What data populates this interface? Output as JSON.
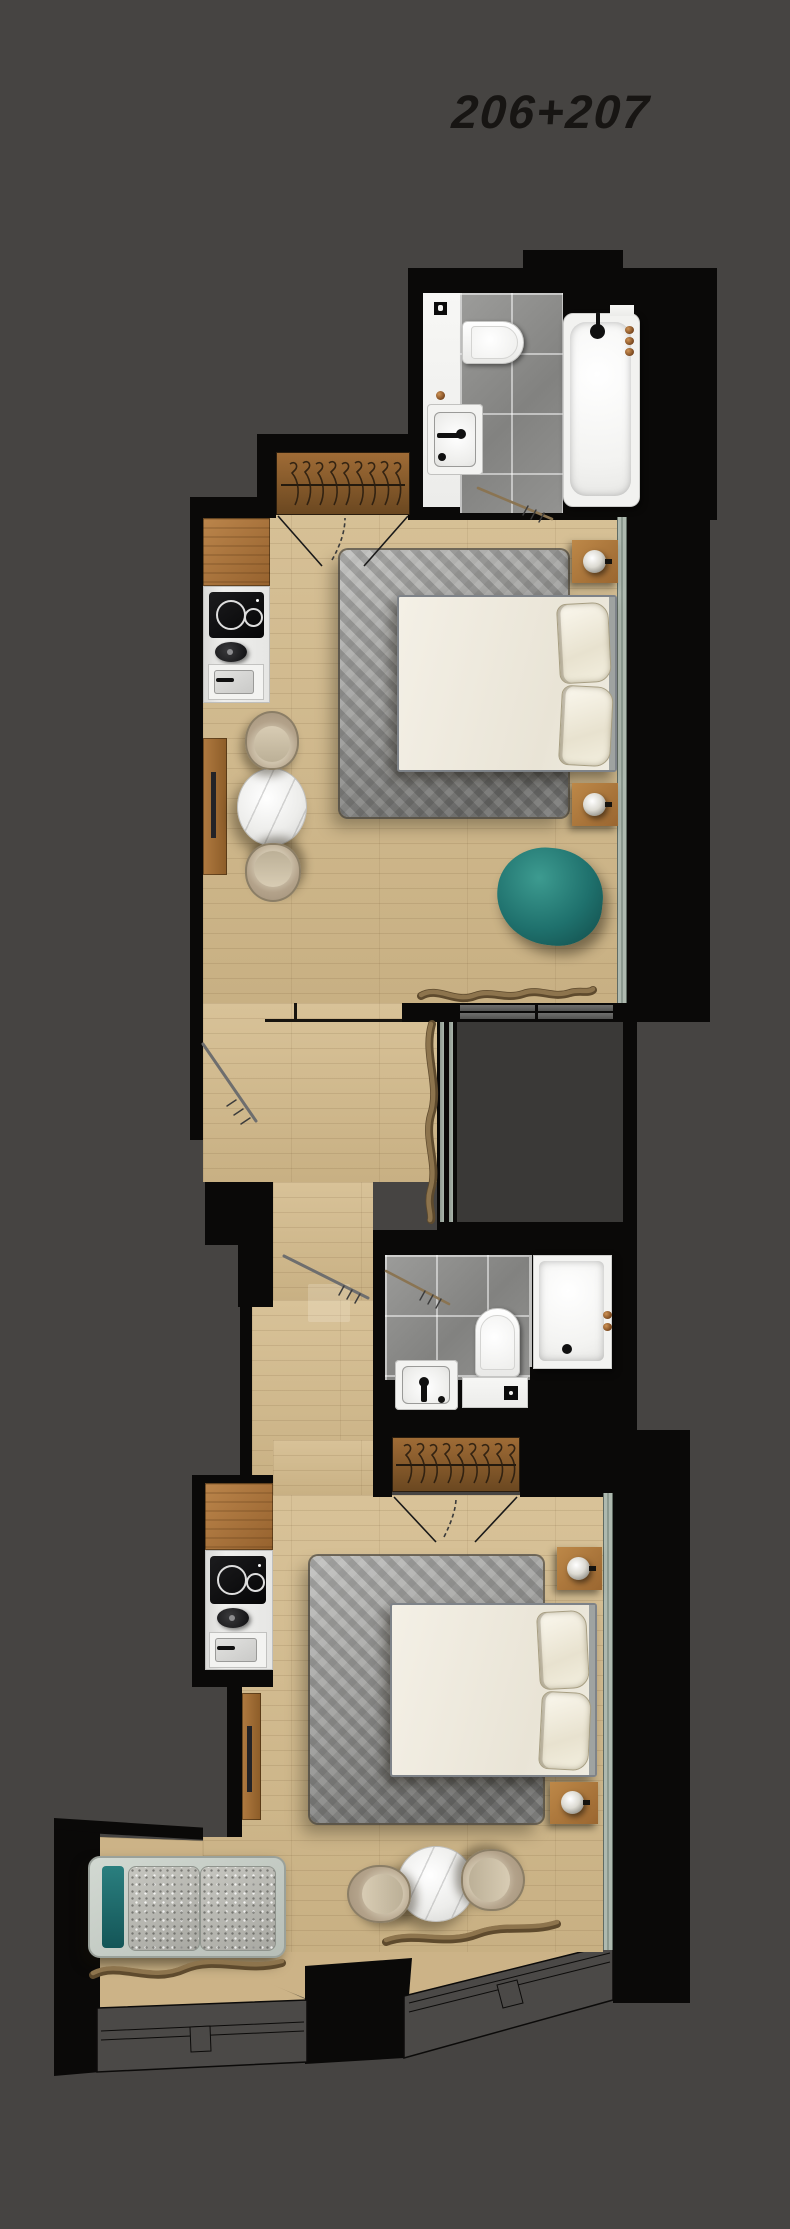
{
  "title": "206+207",
  "palette": {
    "bg": "#464442",
    "wall": "#0a0908",
    "wood": "#cfb88d",
    "counter": "#a9743c",
    "wardrobe": "#86592b",
    "tile": "#929290",
    "rug": "#9c9c9a",
    "windowStrip": "#aeb9af",
    "shaft": "#3a3937",
    "teal": "#1f716d",
    "curtain": "#8d744d",
    "bed": "#f1ede2",
    "marble": "#ececea",
    "chair": "#b3a28a",
    "title": "#171513"
  },
  "plan": {
    "type": "hotel-floor-plan",
    "units_label": "206+207",
    "rooms": [
      {
        "id": "206",
        "areas": [
          "bathroom",
          "wardrobe",
          "kitchenette",
          "sleeping-area",
          "lounge-area"
        ],
        "fixtures": [
          "bathtub",
          "shower-head",
          "toilet",
          "washbasin",
          "toilet-paper-holder",
          "hanging-rail",
          "induction-hob",
          "kettle",
          "kitchen-sink",
          "double-bed",
          "pillows",
          "rug",
          "nightstand-lamp",
          "nightstand-lamp",
          "tv-console",
          "round-table",
          "armchair",
          "armchair",
          "beanbag",
          "curtain",
          "window"
        ]
      },
      {
        "id": "207",
        "areas": [
          "entry-hall",
          "bathroom",
          "wardrobe",
          "kitchenette",
          "sleeping-area",
          "lounge-area"
        ],
        "fixtures": [
          "shower",
          "toilet",
          "washbasin",
          "hanging-rail",
          "induction-hob",
          "kettle",
          "kitchen-sink",
          "double-bed",
          "pillows",
          "rug",
          "nightstand-lamp",
          "nightstand-lamp",
          "tv-console",
          "round-table",
          "armchair",
          "armchair",
          "daybed",
          "curtain",
          "window"
        ]
      }
    ],
    "connector": "shared-corridor-with-lightwell"
  }
}
